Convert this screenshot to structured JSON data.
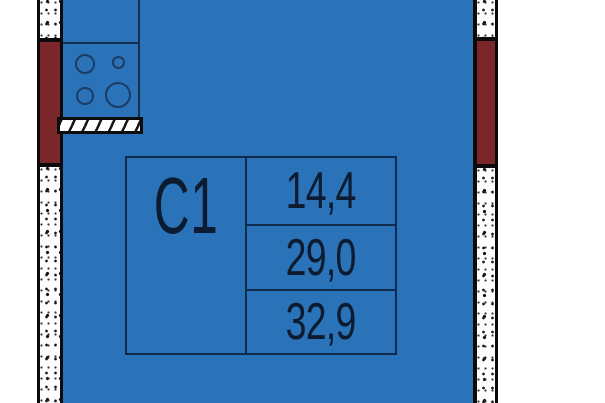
{
  "floor_plan": {
    "unit_label": "C1",
    "areas": [
      "14,4",
      "29,0",
      "32,9"
    ],
    "colors": {
      "floor_blue": "#2b73b8",
      "wall_red": "#7b2629",
      "wall_fill": "#fdfdfd",
      "outline_black": "#0b0b0b",
      "table_line_navy": "#0f2b4e",
      "text_navy": "#0c1b30"
    }
  }
}
